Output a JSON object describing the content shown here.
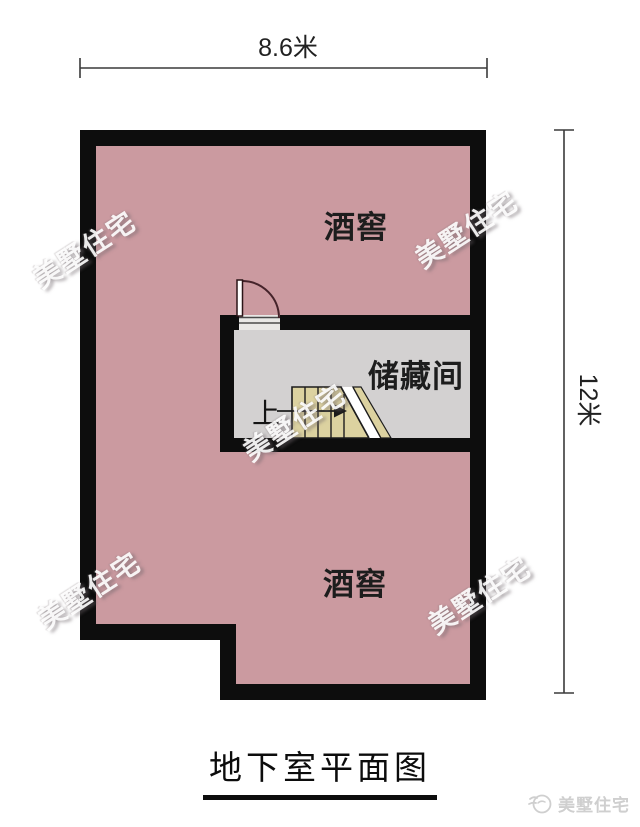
{
  "diagram": {
    "kind": "floor-plan",
    "floor": "basement"
  },
  "dimensions": {
    "width": {
      "label": "8.6米"
    },
    "height": {
      "label": "12米"
    }
  },
  "rooms": {
    "wine_cellar_top": {
      "label": "酒窖"
    },
    "storage_room": {
      "label": "储藏间"
    },
    "wine_cellar_bottom": {
      "label": "酒窖"
    },
    "stairs": {
      "direction_label": "上"
    }
  },
  "title": {
    "text": "地下室平面图"
  },
  "brand": {
    "logo_text": "美墅住宅",
    "logo_icon": "swallow-logo-icon"
  },
  "watermark": {
    "text": "美墅住宅"
  },
  "colors": {
    "wall": "#0d0d0d",
    "wine_cellar_fill": "#cb9aa0",
    "storage_fill": "#d3d1d1",
    "stairs_fill": "#dcd2a0",
    "door_arc": "#45232a",
    "dimension_line": "#3a3a3a",
    "watermark_text": "#ffffff",
    "logo_gray": "#cfcfcf"
  }
}
